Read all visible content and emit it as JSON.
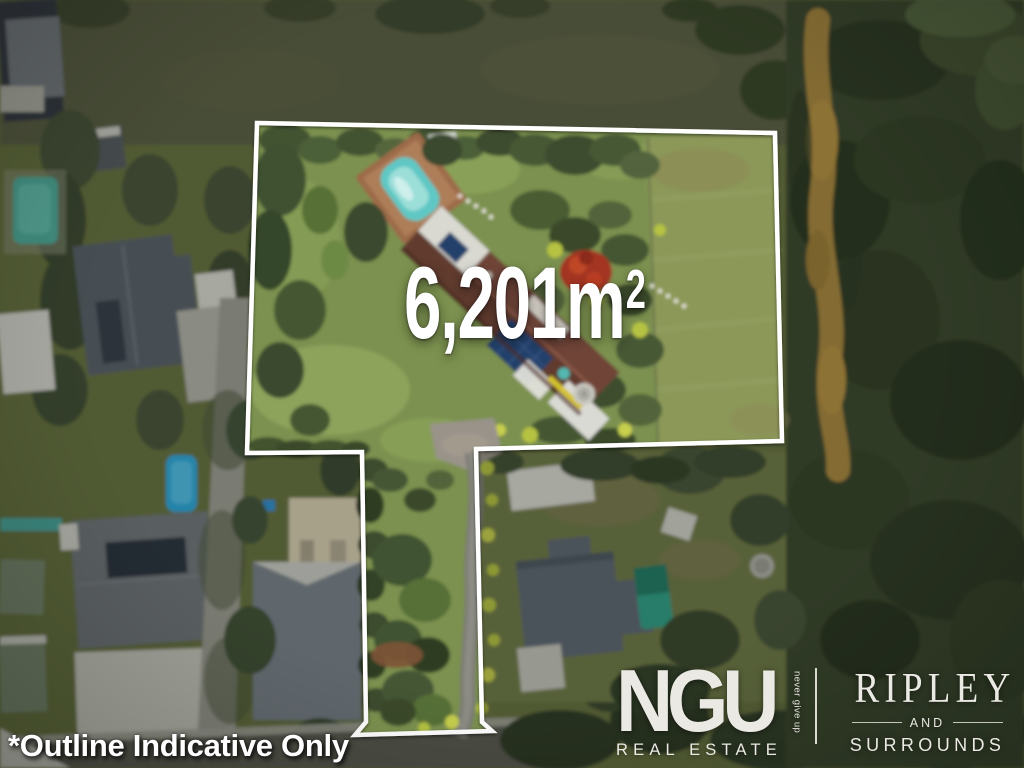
{
  "overlay": {
    "area": {
      "value": "6,201m",
      "superscript": "2"
    },
    "disclaimer": "*Outline Indicative Only"
  },
  "branding": {
    "ngu": {
      "name": "NGU",
      "tagline": "never give up",
      "division": "REAL ESTATE"
    },
    "partner": {
      "name": "RIPLEY",
      "connector": "AND",
      "region": "SURROUNDS"
    }
  },
  "colors": {
    "outline": "#ffffff",
    "overlay_text": "#ffffff",
    "logo_text": "#eae9e3",
    "lawn": "#7b9150",
    "forest": "#3a462f",
    "creek": "#a9873f",
    "main_roof": "#6f4539",
    "pool_teal": "#5ec8c4",
    "pool_blue": "#2aa7dc",
    "neighbor_pool": "#2f9e86",
    "solar_panel": "#24406b",
    "road": "#5b5b53"
  }
}
